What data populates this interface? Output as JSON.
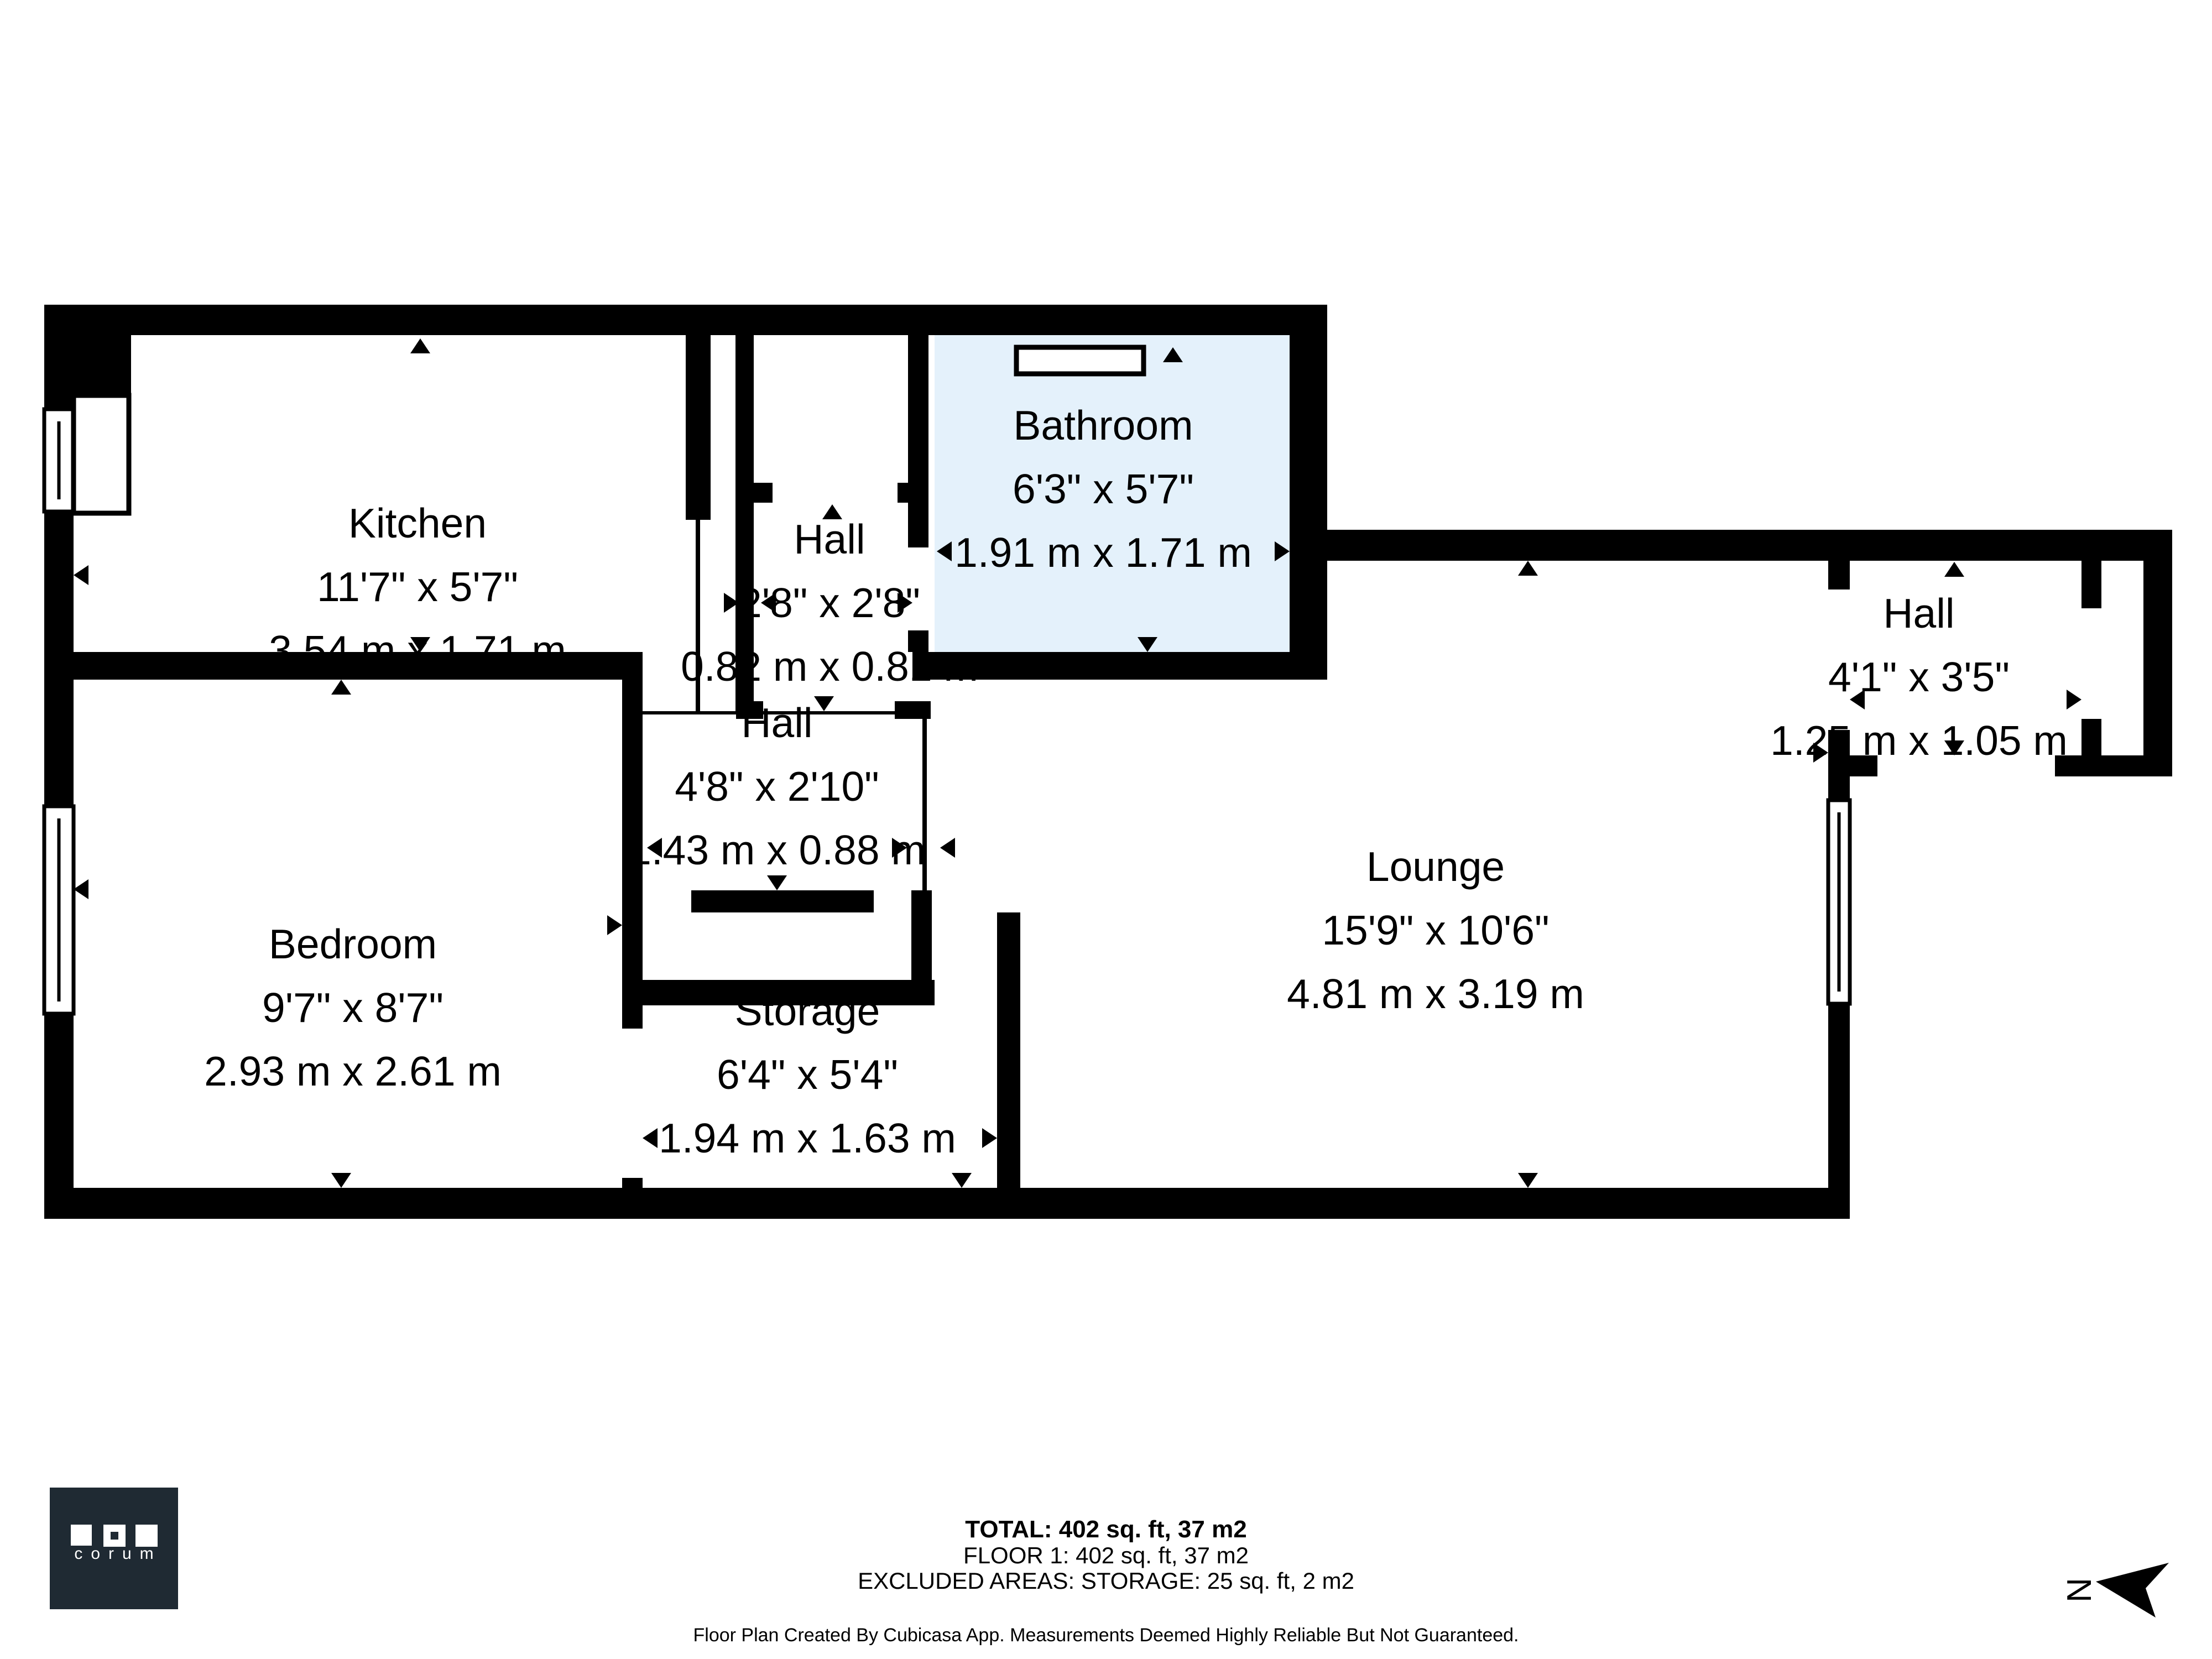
{
  "rooms": [
    {
      "id": "kitchen",
      "name": "Kitchen",
      "imperial": "11'7\" x 5'7\"",
      "metric": "3.54 m x 1.71 m"
    },
    {
      "id": "hall-small",
      "name": "Hall",
      "imperial": "2'8\" x 2'8\"",
      "metric": "0.82 m x 0.81 m"
    },
    {
      "id": "bathroom",
      "name": "Bathroom",
      "imperial": "6'3\" x 5'7\"",
      "metric": "1.91 m x 1.71 m"
    },
    {
      "id": "hall-right",
      "name": "Hall",
      "imperial": "4'1\" x 3'5\"",
      "metric": "1.25 m x 1.05 m"
    },
    {
      "id": "hall-center",
      "name": "Hall",
      "imperial": "4'8\" x 2'10\"",
      "metric": "1.43 m x 0.88 m"
    },
    {
      "id": "bedroom",
      "name": "Bedroom",
      "imperial": "9'7\" x 8'7\"",
      "metric": "2.93 m x 2.61 m"
    },
    {
      "id": "storage",
      "name": "Storage",
      "imperial": "6'4\" x 5'4\"",
      "metric": "1.94 m x 1.63 m"
    },
    {
      "id": "lounge",
      "name": "Lounge",
      "imperial": "15'9\" x 10'6\"",
      "metric": "4.81 m x 3.19 m"
    }
  ],
  "summary": {
    "total": "TOTAL: 402 sq. ft, 37 m2",
    "floor": "FLOOR 1: 402 sq. ft, 37 m2",
    "excluded": "EXCLUDED AREAS: STORAGE: 25 sq. ft, 2 m2",
    "disclaimer": "Floor Plan Created By Cubicasa App. Measurements Deemed Highly Reliable But Not Guaranteed."
  },
  "logo": {
    "text": "corum"
  },
  "compass": {
    "label": "N"
  },
  "colors": {
    "wall": "#000000",
    "bathroom_fill": "#e4f1fb",
    "logo_bg": "#1f2a33",
    "page": "#ffffff"
  }
}
